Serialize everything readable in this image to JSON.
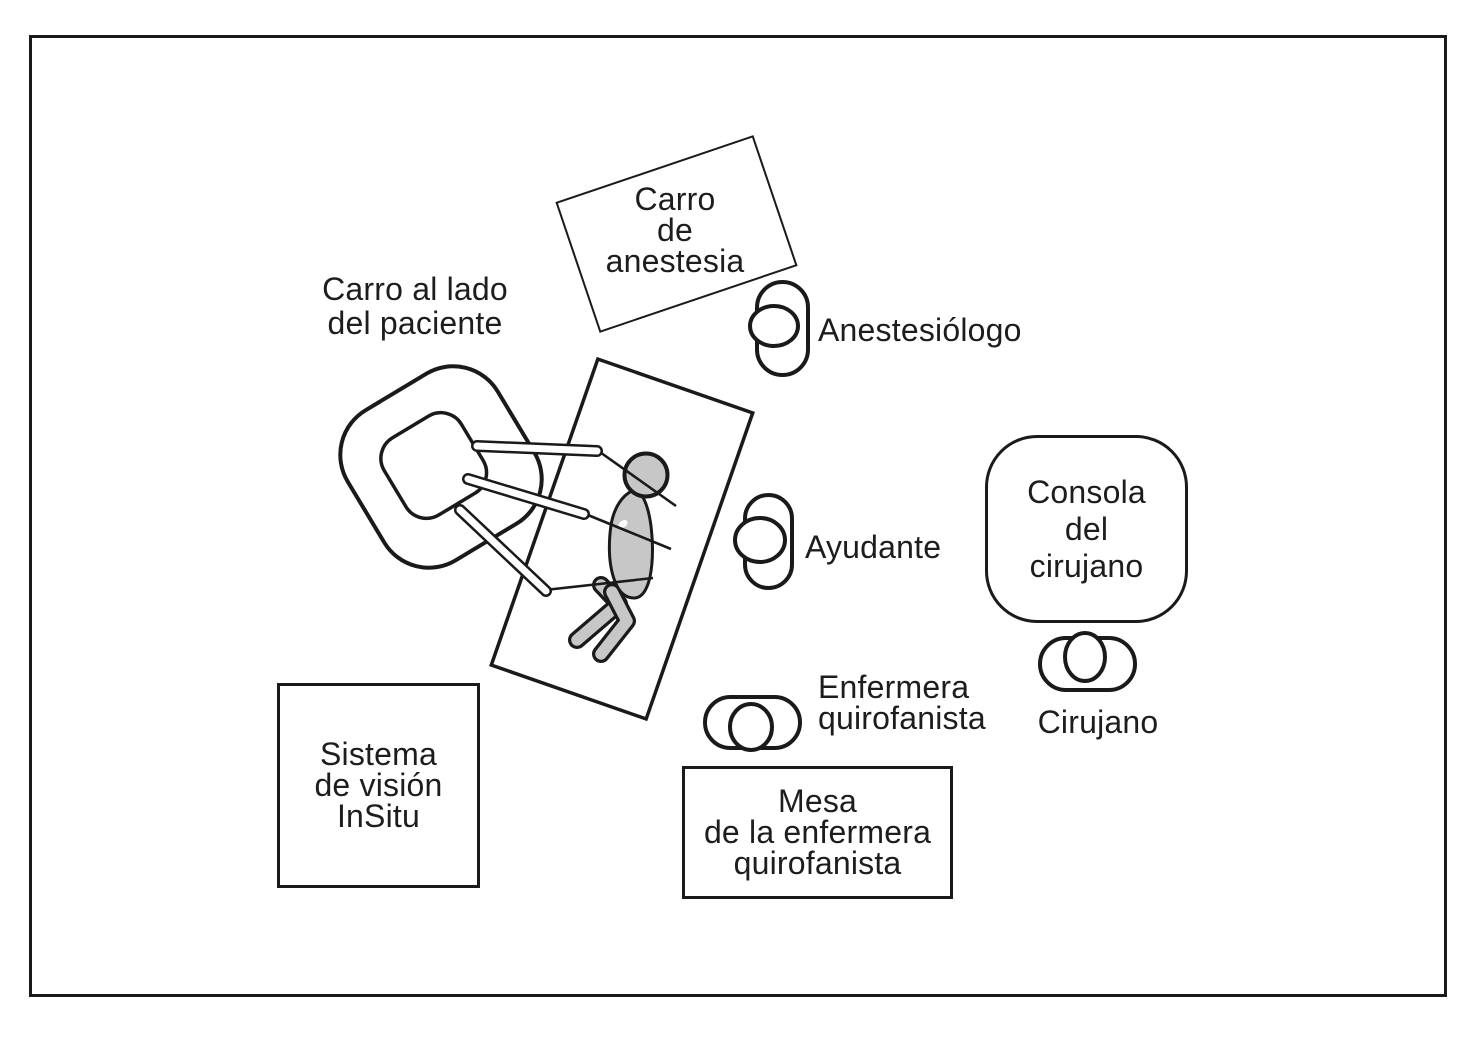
{
  "figure": {
    "type": "operating-room-layout-diagram",
    "colors": {
      "line": "#1a1a1a",
      "patient_fill": "#c7c7c7",
      "background": "#ffffff"
    },
    "boxes": {
      "anesthesia_cart": "Carro\nde\nanestesia",
      "surgeon_console": "Consola\ndel\ncirujano",
      "nurse_table": "Mesa\nde la enfermera\nquirofanista",
      "vision_system": "Sistema\nde visión\nInSitu"
    },
    "labels": {
      "patient_cart": "Carro al lado\ndel paciente",
      "anesthesiologist": "Anestesiólogo",
      "assistant": "Ayudante",
      "surgeon": "Cirujano",
      "scrub_nurse": "Enfermera\nquirofanista"
    },
    "icons": {
      "anesthesiologist": "person-top-view-icon",
      "assistant": "person-top-view-icon",
      "surgeon": "person-top-view-icon",
      "scrub_nurse": "person-top-view-icon",
      "patient": "patient-lying-figure",
      "patient_cart": "robot-patient-side-cart",
      "operating_table": "operating-table-rectangle"
    }
  }
}
